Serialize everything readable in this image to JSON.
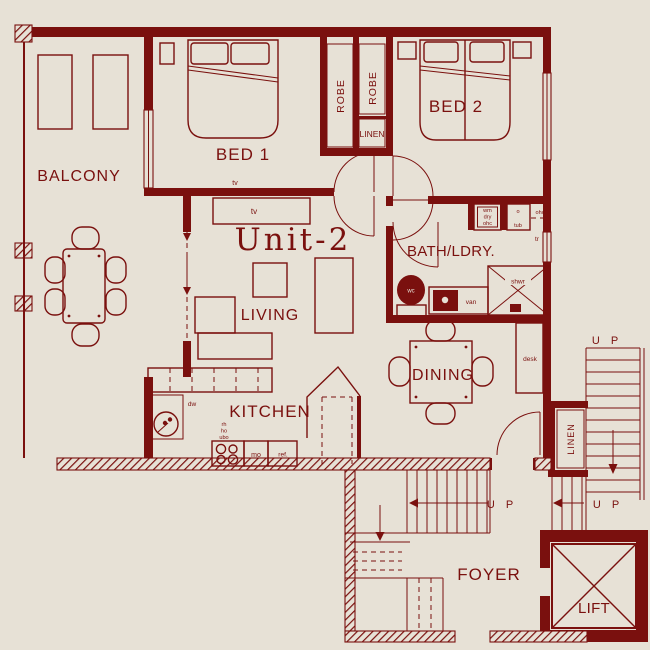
{
  "colors": {
    "background": "#e7e1d6",
    "ink": "#7a100e"
  },
  "unit": {
    "title": "Unit-2"
  },
  "rooms": {
    "balcony": "BALCONY",
    "bed1": "BED 1",
    "bed2": "BED 2",
    "living": "LIVING",
    "kitchen": "KITCHEN",
    "dining": "DINING",
    "bath_laundry": "BATH/LDRY.",
    "foyer": "FOYER",
    "lift": "LIFT"
  },
  "storage": {
    "robe_1": "ROBE",
    "robe_2": "ROBE",
    "linen_hall": "LINEN",
    "linen_foyer": "LINEN"
  },
  "fixtures": {
    "tv_bed1": "tv",
    "tv_living": "tv",
    "desk": "desk",
    "wm": "wm",
    "dry": "dry",
    "ohc_a": "ohc",
    "tub_o": "o",
    "tub": "tub",
    "ohc_b": "ohc",
    "towel_rail": "tr",
    "wc": "wc",
    "vanity": "van",
    "shower": "shwr",
    "dishwasher": "dw",
    "rangehood": "rh",
    "hotplate": "ho",
    "underbench_oven": "ubo",
    "microwave": "mo",
    "fridge": "ref."
  },
  "stairs": {
    "up_foyer": "U P",
    "up_landing": "U P",
    "up_flight": "U P"
  }
}
